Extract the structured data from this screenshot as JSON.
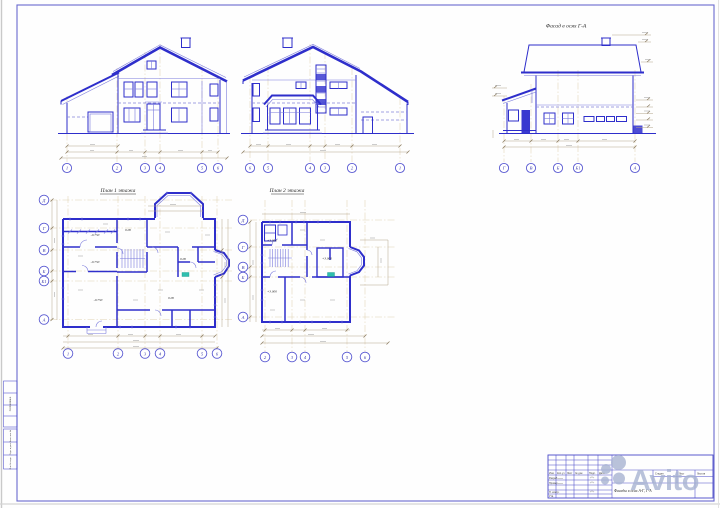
{
  "watermark": {
    "text": "Avito",
    "color": "#a8b4d2"
  },
  "elevation_front": {
    "axes": [
      "1",
      "2",
      "3",
      "4",
      "5",
      "6"
    ]
  },
  "elevation_rear": {
    "axes": [
      "6",
      "5",
      "4",
      "3",
      "2",
      "1"
    ]
  },
  "elevation_side": {
    "title": "Фасад в осях Г-А",
    "axes": [
      "Г",
      "В",
      "Б",
      "Б1",
      "А"
    ]
  },
  "plan1": {
    "title": "План 1 этажа",
    "axes_bottom": [
      "1",
      "2",
      "3",
      "4",
      "5",
      "6"
    ],
    "axes_left": [
      "Д",
      "Г",
      "В",
      "Б",
      "Б1",
      "А"
    ],
    "levels": [
      "-0.750",
      "-0.750",
      "-0.750",
      "0.00",
      "0.00",
      "0.00"
    ]
  },
  "plan2": {
    "title": "План 2 этажа",
    "axes_bottom": [
      "2",
      "3",
      "4",
      "5",
      "6"
    ],
    "axes_left": [
      "Д",
      "Г",
      "В",
      "Б",
      "А"
    ],
    "levels": [
      "+3.000",
      "+3.000",
      "+3.000"
    ]
  },
  "title_block": {
    "header_cols": [
      "Изм.",
      "Кол.уч",
      "Лист",
      "№ док.",
      "Подп.",
      "Дата"
    ],
    "rows": [
      "Разраб.",
      "Провер.",
      "",
      "Н. контр.",
      "Утв."
    ],
    "drawing_title": "Фасады в осях А-Г, Г-А",
    "stage_label": "Стадия",
    "sheet_label": "Лист",
    "sheets_label": "Листов"
  },
  "side_strip": {
    "labels": [
      "Согласовано",
      "Взам. инв. №",
      "Подп. и дата",
      "Инв. № подл."
    ]
  }
}
